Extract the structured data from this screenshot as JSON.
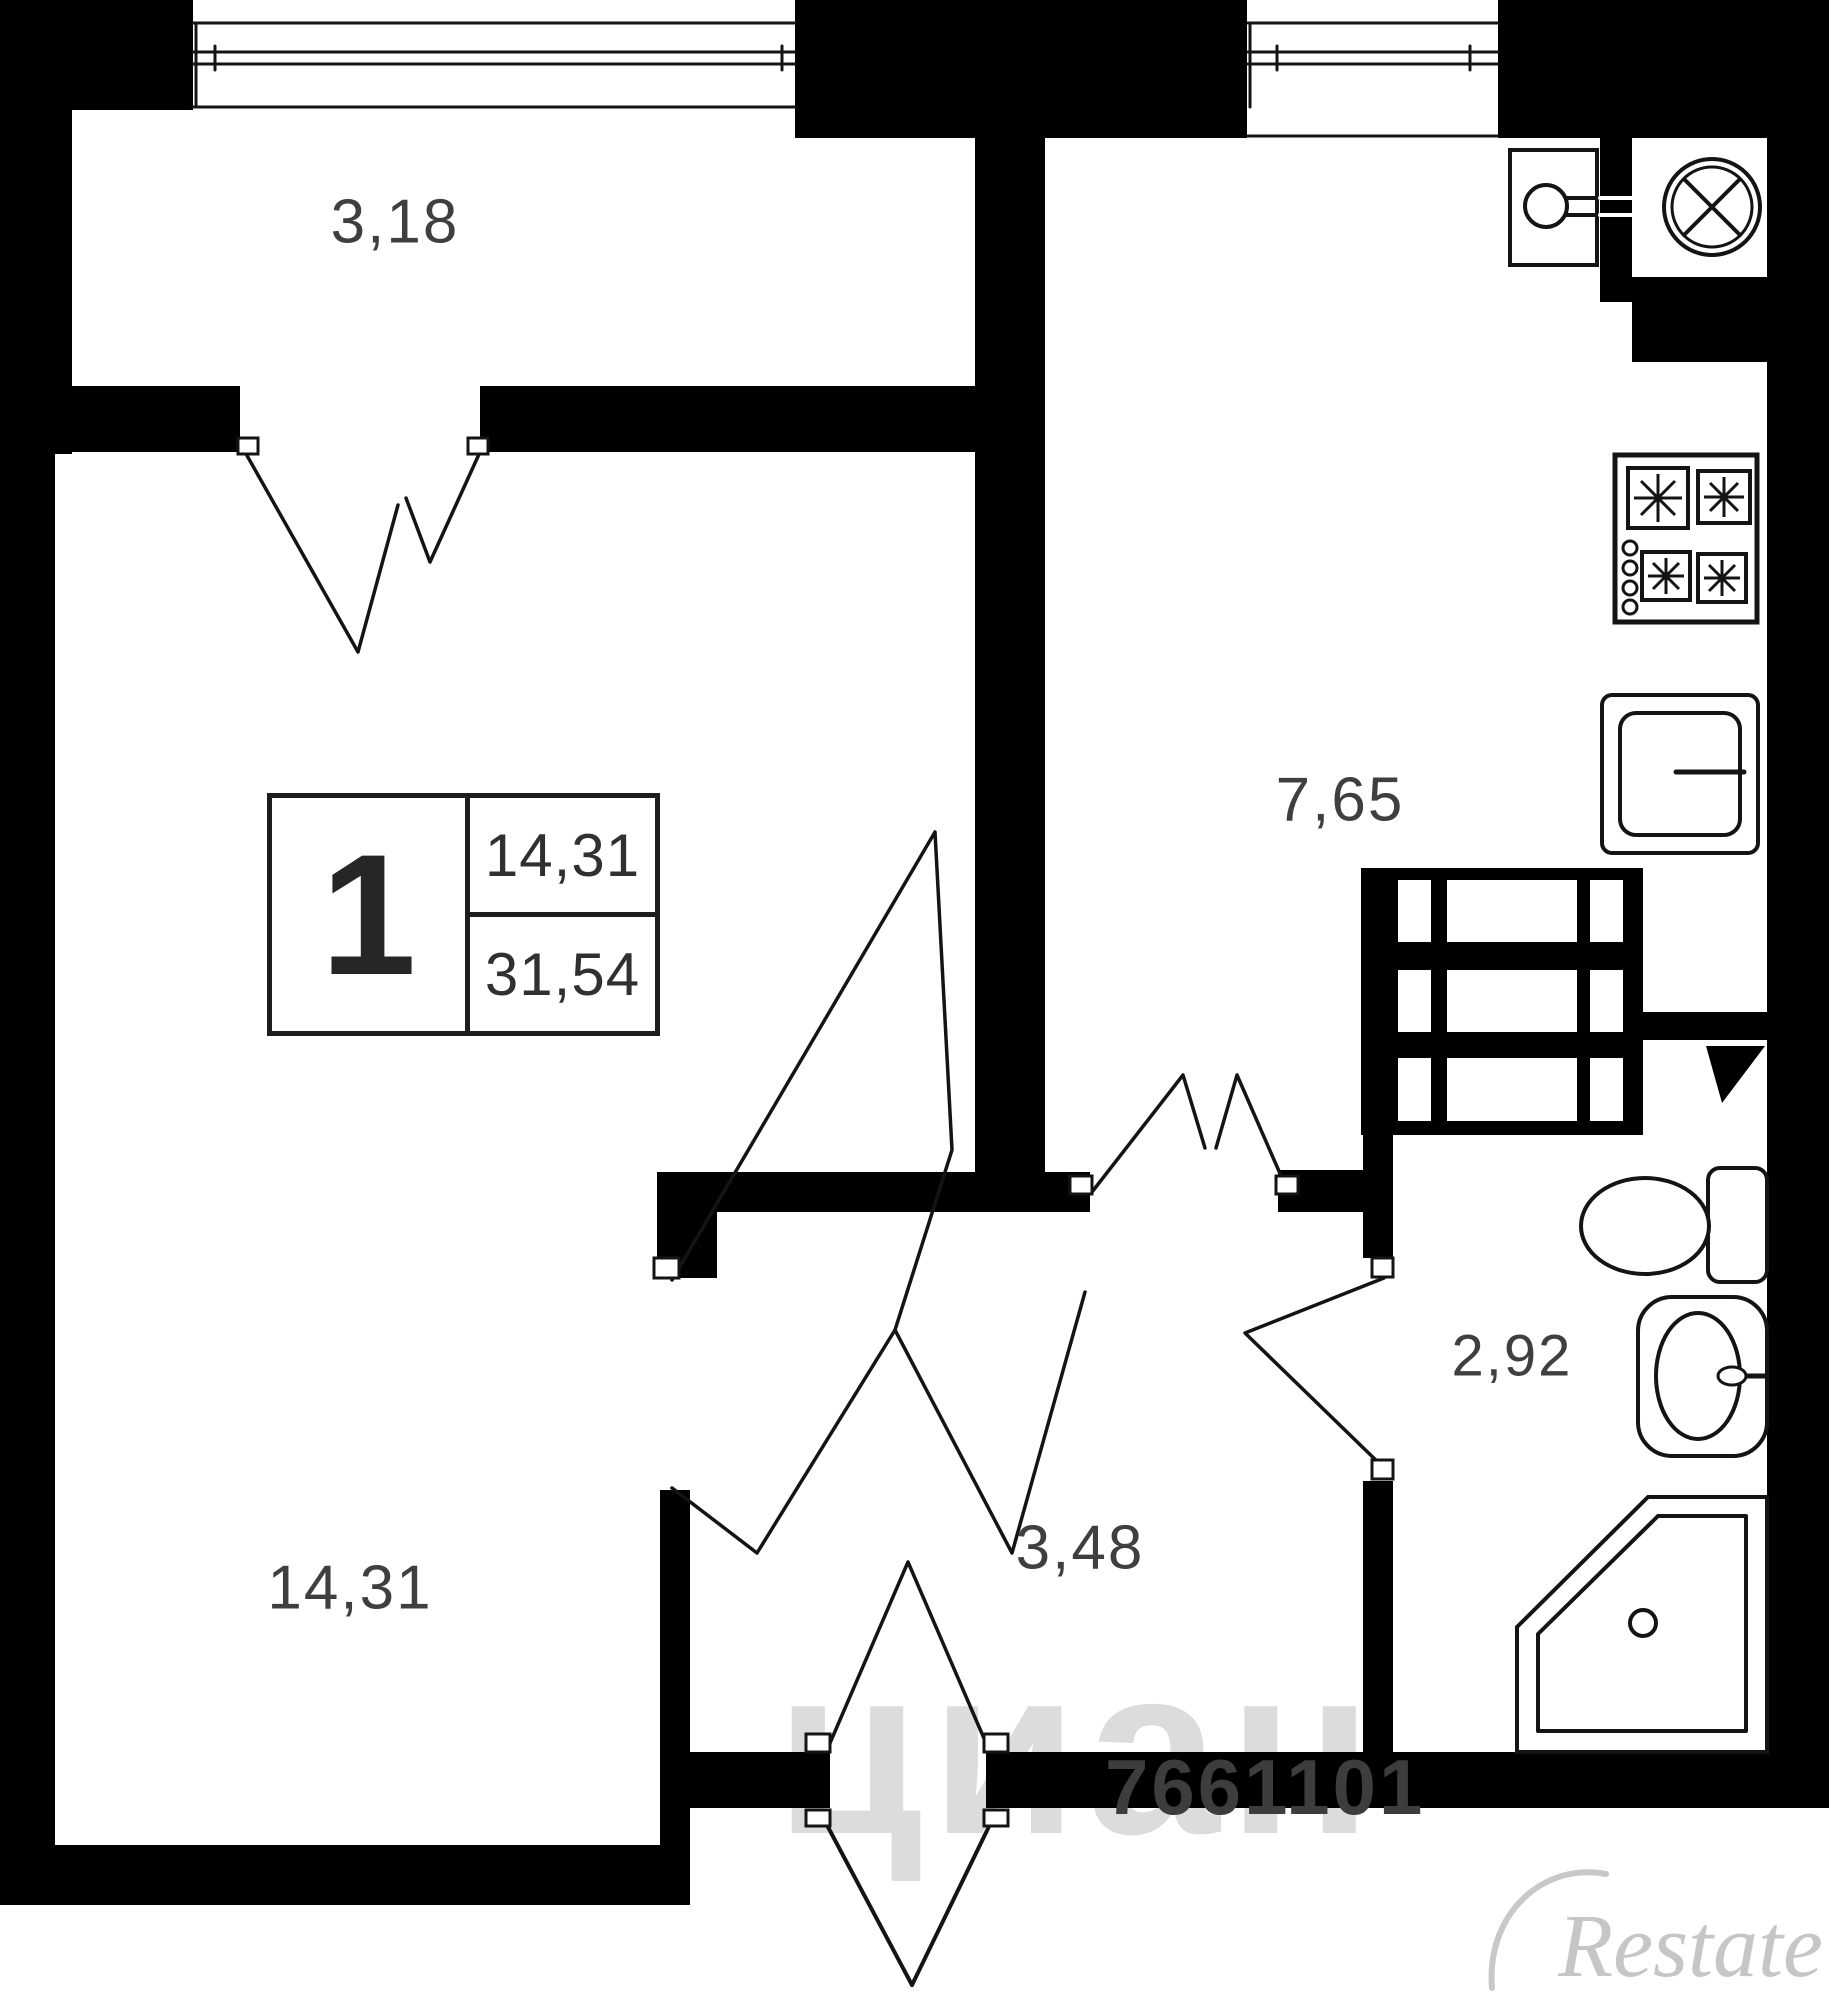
{
  "meta": {
    "width": 1829,
    "height": 2000,
    "bg": "#ffffff",
    "wall_color": "#000000",
    "line_color": "#141414",
    "label_color": "#3f3f3f"
  },
  "rooms": [
    {
      "id": "balcony",
      "label": "3,18",
      "x": 395,
      "y": 222,
      "fs": 62
    },
    {
      "id": "living-room",
      "label": "14,31",
      "x": 350,
      "y": 1588,
      "fs": 62
    },
    {
      "id": "kitchen",
      "label": "7,65",
      "x": 1340,
      "y": 800,
      "fs": 62
    },
    {
      "id": "hallway",
      "label": "3,48",
      "x": 1080,
      "y": 1548,
      "fs": 62
    },
    {
      "id": "bathroom",
      "label": "2,92",
      "x": 1512,
      "y": 1356,
      "fs": 58
    }
  ],
  "info_box": {
    "rooms_count": "1",
    "living_area": "14,31",
    "total_area": "31,54"
  },
  "watermarks": {
    "listing_id": "7661101",
    "portal": "циан",
    "brand": "Restate"
  },
  "plan": {
    "shapes": [
      {
        "n": "top-left-corner-block",
        "t": "r",
        "a": [
          0,
          0,
          193,
          110
        ]
      },
      {
        "n": "balcony-left-wall",
        "t": "r",
        "a": [
          0,
          108,
          72,
          346
        ]
      },
      {
        "n": "left-outer-wall",
        "t": "r",
        "a": [
          0,
          108,
          55,
          1797
        ]
      },
      {
        "n": "balcony-inner-wall-left",
        "t": "r",
        "a": [
          28,
          386,
          212,
          66
        ]
      },
      {
        "n": "balcony-inner-wall-right",
        "t": "r",
        "a": [
          480,
          386,
          495,
          66
        ]
      },
      {
        "n": "window-pillar",
        "t": "r",
        "a": [
          795,
          0,
          452,
          138
        ]
      },
      {
        "n": "living-kitchen-wall",
        "t": "r",
        "a": [
          975,
          108,
          70,
          1104
        ]
      },
      {
        "n": "top-right-corner-block",
        "t": "r",
        "a": [
          1498,
          0,
          331,
          138
        ]
      },
      {
        "n": "vent-niche-strip",
        "t": "r",
        "a": [
          1600,
          138,
          32,
          164
        ]
      },
      {
        "n": "below-niche-block",
        "t": "r",
        "a": [
          1632,
          277,
          197,
          85
        ]
      },
      {
        "n": "right-outer-wall",
        "t": "r",
        "a": [
          1767,
          138,
          62,
          1670
        ]
      },
      {
        "n": "kitchen-hall-wall",
        "t": "r",
        "a": [
          657,
          1172,
          433,
          40
        ]
      },
      {
        "n": "hall-stub-wall",
        "t": "r",
        "a": [
          657,
          1172,
          60,
          106
        ]
      },
      {
        "n": "kitchen-hall-wall-right",
        "t": "r",
        "a": [
          1278,
          1170,
          85,
          42
        ]
      },
      {
        "n": "kitchen-bath-wall",
        "t": "r",
        "a": [
          1643,
          1012,
          124,
          28
        ]
      },
      {
        "n": "bath-wall-upper",
        "t": "r",
        "a": [
          1363,
          1135,
          30,
          123
        ]
      },
      {
        "n": "bath-wall-lower",
        "t": "r",
        "a": [
          1363,
          1481,
          30,
          271
        ]
      },
      {
        "n": "entry-wall-left",
        "t": "r",
        "a": [
          660,
          1752,
          170,
          56
        ]
      },
      {
        "n": "entry-wall-right",
        "t": "r",
        "a": [
          986,
          1752,
          804,
          56
        ]
      },
      {
        "n": "living-bottom-wall",
        "t": "r",
        "a": [
          0,
          1845,
          690,
          60
        ]
      },
      {
        "n": "living-hall-wall",
        "t": "r",
        "a": [
          660,
          1490,
          30,
          415
        ]
      },
      {
        "n": "vent-shaft-block",
        "t": "r",
        "a": [
          1361,
          868,
          282,
          267
        ]
      },
      {
        "n": "shaft-cell",
        "t": "r",
        "a": [
          1398,
          880,
          33,
          62
        ],
        "f": "#ffffff"
      },
      {
        "n": "shaft-cell",
        "t": "r",
        "a": [
          1447,
          880,
          130,
          62
        ],
        "f": "#ffffff"
      },
      {
        "n": "shaft-cell",
        "t": "r",
        "a": [
          1590,
          880,
          33,
          62
        ],
        "f": "#ffffff"
      },
      {
        "n": "shaft-cell",
        "t": "r",
        "a": [
          1398,
          970,
          33,
          62
        ],
        "f": "#ffffff"
      },
      {
        "n": "shaft-cell",
        "t": "r",
        "a": [
          1447,
          970,
          130,
          62
        ],
        "f": "#ffffff"
      },
      {
        "n": "shaft-cell",
        "t": "r",
        "a": [
          1590,
          970,
          33,
          62
        ],
        "f": "#ffffff"
      },
      {
        "n": "shaft-cell",
        "t": "r",
        "a": [
          1398,
          1058,
          33,
          63
        ],
        "f": "#ffffff"
      },
      {
        "n": "shaft-cell",
        "t": "r",
        "a": [
          1447,
          1058,
          130,
          63
        ],
        "f": "#ffffff"
      },
      {
        "n": "shaft-cell",
        "t": "r",
        "a": [
          1590,
          1058,
          33,
          63
        ],
        "f": "#ffffff"
      },
      {
        "n": "balcony-window-outer",
        "t": "l",
        "a": [
          193,
          23,
          795,
          23
        ]
      },
      {
        "n": "balcony-window-glass-1",
        "t": "l",
        "a": [
          193,
          52,
          795,
          52
        ]
      },
      {
        "n": "balcony-window-glass-2",
        "t": "l",
        "a": [
          193,
          64,
          795,
          64
        ]
      },
      {
        "n": "balcony-window-sill",
        "t": "l",
        "a": [
          193,
          107,
          795,
          107
        ]
      },
      {
        "n": "balcony-window-frame",
        "t": "l",
        "a": [
          196,
          23,
          196,
          107
        ]
      },
      {
        "n": "balcony-window-tick-1",
        "t": "l",
        "a": [
          215,
          46,
          215,
          70
        ]
      },
      {
        "n": "balcony-window-tick-2",
        "t": "l",
        "a": [
          782,
          46,
          782,
          70
        ]
      },
      {
        "n": "kitchen-window-outer",
        "t": "l",
        "a": [
          1248,
          23,
          1498,
          23
        ]
      },
      {
        "n": "kitchen-window-glass-1",
        "t": "l",
        "a": [
          1248,
          52,
          1498,
          52
        ]
      },
      {
        "n": "kitchen-window-glass-2",
        "t": "l",
        "a": [
          1248,
          64,
          1498,
          64
        ]
      },
      {
        "n": "kitchen-window-sill",
        "t": "l",
        "a": [
          1248,
          136,
          1498,
          136
        ]
      },
      {
        "n": "kitchen-window-frame",
        "t": "l",
        "a": [
          1250,
          23,
          1250,
          107
        ]
      },
      {
        "n": "kitchen-window-tick-1",
        "t": "l",
        "a": [
          1277,
          46,
          1277,
          70
        ]
      },
      {
        "n": "kitchen-window-tick-2",
        "t": "l",
        "a": [
          1470,
          46,
          1470,
          70
        ]
      },
      {
        "n": "fan-symbol-outer",
        "t": "c",
        "a": [
          1712,
          207,
          48
        ],
        "s": 4
      },
      {
        "n": "fan-symbol-inner",
        "t": "c",
        "a": [
          1712,
          207,
          40
        ],
        "s": 3
      },
      {
        "n": "fan-blade-1",
        "t": "l",
        "a": [
          1684,
          179,
          1740,
          235
        ],
        "s": 4
      },
      {
        "n": "fan-blade-2",
        "t": "l",
        "a": [
          1740,
          179,
          1684,
          235
        ],
        "s": 4
      },
      {
        "n": "boiler-box",
        "t": "r",
        "a": [
          1510,
          150,
          87,
          115
        ],
        "s": 4,
        "f": "#ffffff"
      },
      {
        "n": "boiler-circle",
        "t": "c",
        "a": [
          1546,
          206,
          21
        ],
        "s": 4
      },
      {
        "n": "boiler-pipe-1",
        "t": "l",
        "a": [
          1567,
          198,
          1600,
          198
        ],
        "s": 4
      },
      {
        "n": "boiler-pipe-2",
        "t": "l",
        "a": [
          1567,
          215,
          1600,
          215
        ],
        "s": 4
      },
      {
        "n": "boiler-pipe-dash-1",
        "t": "l",
        "a": [
          1600,
          198,
          1632,
          198
        ],
        "s": 4,
        "c": "#ffffff"
      },
      {
        "n": "boiler-pipe-dash-2",
        "t": "l",
        "a": [
          1600,
          215,
          1632,
          215
        ],
        "s": 4,
        "c": "#ffffff"
      },
      {
        "n": "stove",
        "t": "r",
        "a": [
          1615,
          455,
          142,
          167
        ],
        "s": 5,
        "f": "#ffffff"
      },
      {
        "n": "stove-burner-1",
        "t": "r",
        "a": [
          1628,
          468,
          60,
          60
        ],
        "s": 4,
        "f": "#ffffff"
      },
      {
        "n": "stove-burner-2",
        "t": "r",
        "a": [
          1698,
          471,
          52,
          52
        ],
        "s": 4,
        "f": "#ffffff"
      },
      {
        "n": "stove-burner-3",
        "t": "r",
        "a": [
          1642,
          552,
          48,
          48
        ],
        "s": 4,
        "f": "#ffffff"
      },
      {
        "n": "stove-burner-4",
        "t": "r",
        "a": [
          1698,
          554,
          48,
          48
        ],
        "s": 4,
        "f": "#ffffff"
      },
      {
        "n": "burner-star-1",
        "t": "st",
        "a": [
          1658,
          498,
          24
        ]
      },
      {
        "n": "burner-star-2",
        "t": "st",
        "a": [
          1724,
          497,
          20
        ]
      },
      {
        "n": "burner-star-3",
        "t": "st",
        "a": [
          1666,
          576,
          18
        ]
      },
      {
        "n": "burner-star-4",
        "t": "st",
        "a": [
          1722,
          578,
          18
        ]
      },
      {
        "n": "stove-knob-1",
        "t": "c",
        "a": [
          1630,
          548,
          7
        ],
        "s": 3
      },
      {
        "n": "stove-knob-2",
        "t": "c",
        "a": [
          1630,
          568,
          7
        ],
        "s": 3
      },
      {
        "n": "stove-knob-3",
        "t": "c",
        "a": [
          1630,
          588,
          7
        ],
        "s": 3
      },
      {
        "n": "stove-knob-4",
        "t": "c",
        "a": [
          1630,
          607,
          7
        ],
        "s": 3
      },
      {
        "n": "kitchen-sink-outer",
        "t": "r",
        "a": [
          1602,
          695,
          156,
          158
        ],
        "s": 4,
        "f": "#ffffff",
        "r": 10
      },
      {
        "n": "kitchen-sink-inner",
        "t": "r",
        "a": [
          1620,
          713,
          120,
          122
        ],
        "s": 4,
        "f": "#ffffff",
        "r": 16
      },
      {
        "n": "kitchen-sink-tap",
        "t": "l",
        "a": [
          1676,
          772,
          1744,
          772
        ],
        "s": 5
      },
      {
        "n": "toilet-tank",
        "t": "r",
        "a": [
          1708,
          1168,
          59,
          114
        ],
        "s": 4,
        "f": "#ffffff",
        "r": 12
      },
      {
        "n": "toilet-bowl",
        "t": "e",
        "a": [
          1645,
          1226,
          64,
          48
        ],
        "s": 4
      },
      {
        "n": "bath-sink-counter",
        "t": "r",
        "a": [
          1638,
          1297,
          129,
          159
        ],
        "s": 4,
        "f": "#ffffff",
        "r": 34
      },
      {
        "n": "bath-sink-bowl",
        "t": "e",
        "a": [
          1698,
          1376,
          42,
          63
        ],
        "s": 4
      },
      {
        "n": "bath-sink-tap",
        "t": "l",
        "a": [
          1740,
          1376,
          1766,
          1376
        ],
        "s": 5
      },
      {
        "n": "bath-sink-knob",
        "t": "e",
        "a": [
          1732,
          1376,
          14,
          9
        ],
        "s": 3
      },
      {
        "n": "shower-tray-outer",
        "t": "g",
        "a": [
          1648,
          1497,
          1767,
          1497,
          1767,
          1752,
          1517,
          1752,
          1517,
          1627
        ],
        "s": 4,
        "f": "#ffffff"
      },
      {
        "n": "shower-tray-inner",
        "t": "p",
        "a": [
          1658,
          1516,
          1746,
          1516,
          1746,
          1731,
          1538,
          1731,
          1538,
          1634,
          1658,
          1516
        ],
        "s": 4
      },
      {
        "n": "shower-drain",
        "t": "c",
        "a": [
          1643,
          1623,
          13
        ],
        "s": 4
      },
      {
        "n": "corner-flag",
        "t": "g",
        "a": [
          1706,
          1046,
          1765,
          1046,
          1722,
          1103
        ],
        "f": "#000000"
      },
      {
        "n": "door-leaf-balcony-left",
        "t": "p",
        "a": [
          245,
          452,
          358,
          652,
          398,
          505
        ]
      },
      {
        "n": "door-leaf-balcony-right",
        "t": "p",
        "a": [
          480,
          452,
          430,
          562,
          406,
          498
        ]
      },
      {
        "n": "door-leaf-kitchen-left",
        "t": "p",
        "a": [
          1092,
          1192,
          1183,
          1075,
          1205,
          1148
        ]
      },
      {
        "n": "door-leaf-kitchen-right",
        "t": "p",
        "a": [
          1285,
          1185,
          1237,
          1075,
          1216,
          1148
        ]
      },
      {
        "n": "door-leaf-bathroom",
        "t": "p",
        "a": [
          1384,
          1278,
          1245,
          1333,
          1384,
          1468
        ]
      },
      {
        "n": "door-leaf-living-spike",
        "t": "p",
        "a": [
          672,
          1280,
          935,
          832,
          952,
          1150,
          895,
          1330
        ]
      },
      {
        "n": "door-star-lower-left",
        "t": "p",
        "a": [
          895,
          1330,
          757,
          1553,
          672,
          1488
        ]
      },
      {
        "n": "door-star-lower-right",
        "t": "p",
        "a": [
          895,
          1330,
          1012,
          1553,
          1085,
          1292
        ]
      },
      {
        "n": "door-leaf-entry",
        "t": "p",
        "a": [
          830,
          1743,
          908,
          1562,
          986,
          1743
        ]
      },
      {
        "n": "door-entry-outside-left",
        "t": "l",
        "a": [
          820,
          1812,
          912,
          1985
        ],
        "s": 4
      },
      {
        "n": "door-entry-outside-right",
        "t": "l",
        "a": [
          996,
          1812,
          912,
          1985
        ],
        "s": 4
      },
      {
        "n": "brand-swoosh",
        "t": "path",
        "d": "M1492,1988 C1486,1912 1545,1862 1606,1874",
        "s": 6,
        "c": "#c8c8c8"
      },
      {
        "n": "hinge-balcony-left",
        "t": "r",
        "a": [
          238,
          438,
          20,
          16
        ],
        "s": 3,
        "f": "#ffffff"
      },
      {
        "n": "hinge-balcony-right",
        "t": "r",
        "a": [
          468,
          438,
          20,
          16
        ],
        "s": 3,
        "f": "#ffffff"
      },
      {
        "n": "hinge-kitchen-left",
        "t": "r",
        "a": [
          1070,
          1176,
          22,
          18
        ],
        "s": 3,
        "f": "#ffffff"
      },
      {
        "n": "hinge-kitchen-right",
        "t": "r",
        "a": [
          1276,
          1176,
          22,
          18
        ],
        "s": 3,
        "f": "#ffffff"
      },
      {
        "n": "hinge-bath-top",
        "t": "r",
        "a": [
          1372,
          1258,
          21,
          19
        ],
        "s": 3,
        "f": "#ffffff"
      },
      {
        "n": "hinge-bath-bottom",
        "t": "r",
        "a": [
          1372,
          1460,
          21,
          19
        ],
        "s": 3,
        "f": "#ffffff"
      },
      {
        "n": "hinge-living",
        "t": "r",
        "a": [
          654,
          1258,
          25,
          20
        ],
        "s": 3,
        "f": "#ffffff"
      },
      {
        "n": "hinge-entry-left",
        "t": "r",
        "a": [
          806,
          1734,
          24,
          18
        ],
        "s": 3,
        "f": "#ffffff"
      },
      {
        "n": "hinge-entry-right",
        "t": "r",
        "a": [
          984,
          1734,
          24,
          18
        ],
        "s": 3,
        "f": "#ffffff"
      },
      {
        "n": "hinge-entry-out-left",
        "t": "r",
        "a": [
          806,
          1810,
          24,
          16
        ],
        "s": 3,
        "f": "#ffffff"
      },
      {
        "n": "hinge-entry-out-right",
        "t": "r",
        "a": [
          984,
          1810,
          24,
          16
        ],
        "s": 3,
        "f": "#ffffff"
      }
    ]
  }
}
